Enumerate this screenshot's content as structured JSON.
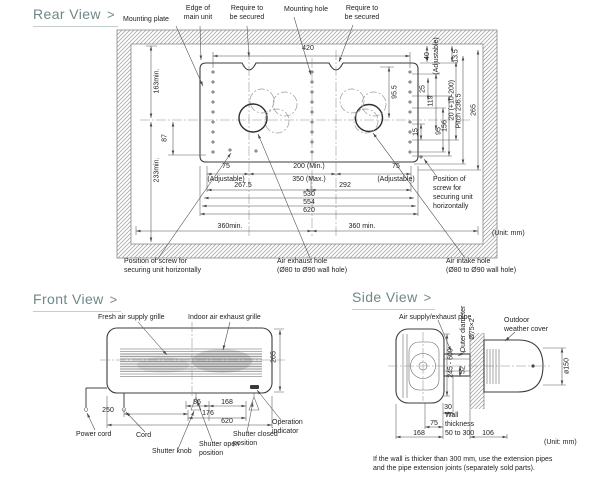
{
  "headings": {
    "rear": "Rear View",
    "front": "Front View",
    "side": "Side View",
    "chevron": ">"
  },
  "colors": {
    "heading": "#6f8787",
    "line": "#4a4a4a",
    "hatch": "#a9a9a9",
    "text": "#1e1e1e"
  },
  "rear": {
    "callouts": {
      "mounting_plate": "Mounting plate",
      "edge_of_main_unit": "Edge of\nmain unit",
      "require_secured_left": "Require to\nbe secured",
      "mounting_hole": "Mounting hole",
      "require_secured_right": "Require to\nbe secured",
      "screw_position_right": "Position of\nscrew for\nsecuring unit\nhorizontally",
      "screw_position_bottom": "Position of screw for\nsecuring unit horizontally",
      "air_exhaust_hole": "Air exhaust hole\n(Ø80 to Ø90 wall hole)",
      "air_intake_hole": "Air intake hole\n(Ø80 to Ø90 wall hole)",
      "unit": "(Unit: mm)"
    },
    "dims": {
      "w420": "420",
      "h95_5": "95.5",
      "gap40": "40\n(Adjustable)",
      "gap13_5": "13.5",
      "left163": "163min.",
      "left87": "87",
      "left233": "233min.",
      "r15": "15",
      "r25": "25",
      "r119": "119",
      "r95": "95",
      "r156": "156",
      "r20": "20 (+10-200)",
      "pitch": "Pitch 236.5",
      "r265": "265",
      "d75L": "75",
      "adjL": "(Adjustable)",
      "d200": "200  (Min.)",
      "d350": "350  (Max.)",
      "d75R": "75",
      "adjR": "(Adjustable)",
      "d267_5": "267.5",
      "d292": "292",
      "d530": "530",
      "d554": "554",
      "d620": "620",
      "d360L": "360min.",
      "d360R": "360 min."
    }
  },
  "front": {
    "callouts": {
      "fresh_grille": "Fresh air supply grille",
      "indoor_grille": "Indoor air exhaust grille",
      "power_cord": "Power cord",
      "cord": "Cord",
      "shutter_knob": "Shutter knob",
      "shutter_open": "Shutter open\nposition",
      "shutter_closed": "Shutter closed\nposition",
      "operation_indicator": "Operation\nindicator"
    },
    "dims": {
      "d86": "86",
      "d168": "168",
      "d250": "250",
      "d176": "176",
      "d620": "620",
      "h265": "265"
    }
  },
  "side": {
    "callouts": {
      "pipe": "Air supply/exhaust pipe",
      "outer_diameter": "Outer diameter\nØ75×2",
      "cover": "Outdoor\nweather cover",
      "wall_thickness": "Wall\nthickness\n50 to 300",
      "unit": "(Unit: mm)"
    },
    "dims": {
      "h245": "245 - 600",
      "d52": "52",
      "d150": "ø150",
      "d30": "30",
      "d75": "75",
      "d168": "168",
      "d106": "106"
    },
    "note": "If the wall is thicker than 300 mm, use the extension pipes\nand the pipe extension joints (separately sold parts)."
  }
}
